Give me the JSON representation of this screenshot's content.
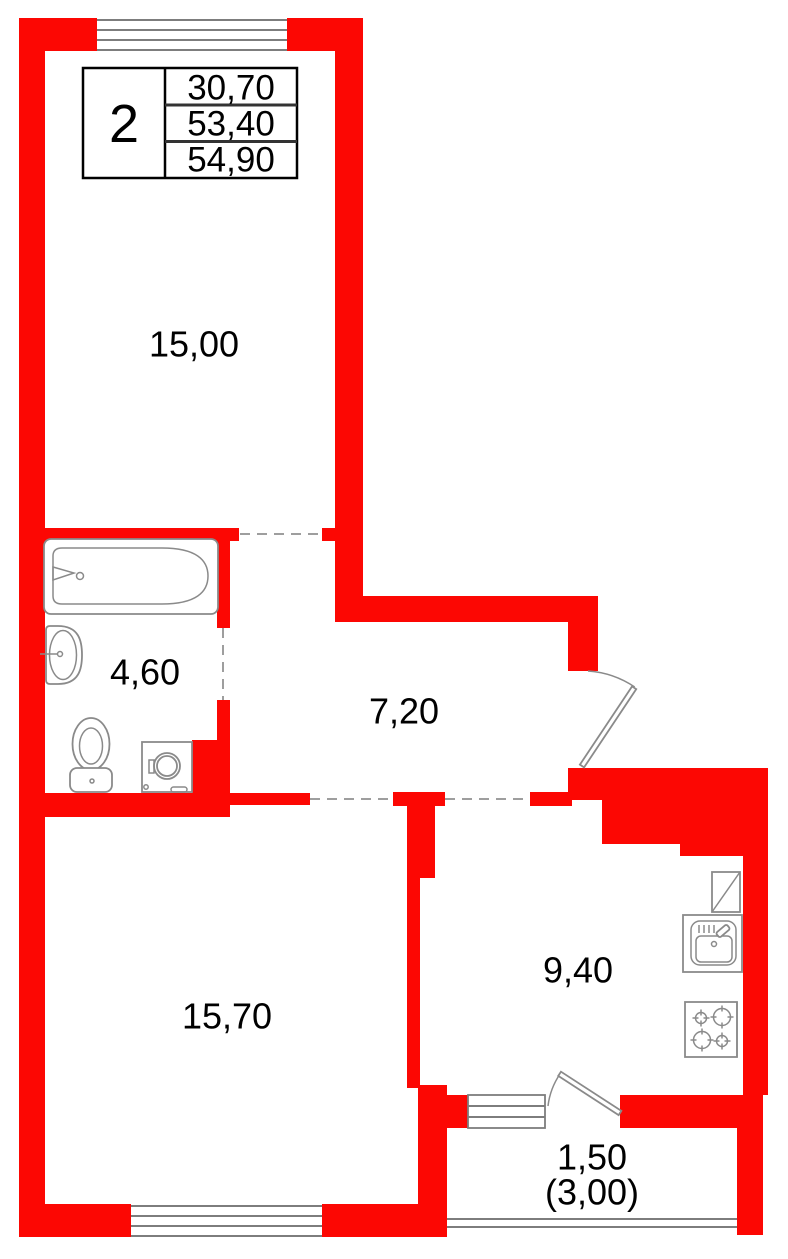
{
  "title": "apartment-floor-plan-2-rooms",
  "colors": {
    "wall": "#fc0703",
    "fixture_line": "#8a8a8a",
    "window_line": "#7d7d7d",
    "dashed_line": "#9e9e9e",
    "text": "#000000",
    "table_border": "#000000"
  },
  "unit_table": {
    "rooms_count": "2",
    "living_area": "30,70",
    "apartment_area": "53,40",
    "total_area": "54,90"
  },
  "rooms": {
    "living_room": {
      "label": "15,00"
    },
    "bathroom": {
      "label": "4,60"
    },
    "hallway": {
      "label": "7,20"
    },
    "bedroom": {
      "label": "15,70"
    },
    "kitchen": {
      "label": "9,40"
    },
    "balcony": {
      "label": "1,50",
      "label_secondary": "(3,00)"
    }
  },
  "fixtures": [
    "bathtub",
    "wash-basin",
    "toilet",
    "washing-machine",
    "refrigerator",
    "kitchen-sink",
    "stove",
    "entry-door",
    "balcony-door",
    "window",
    "balcony-railing"
  ]
}
